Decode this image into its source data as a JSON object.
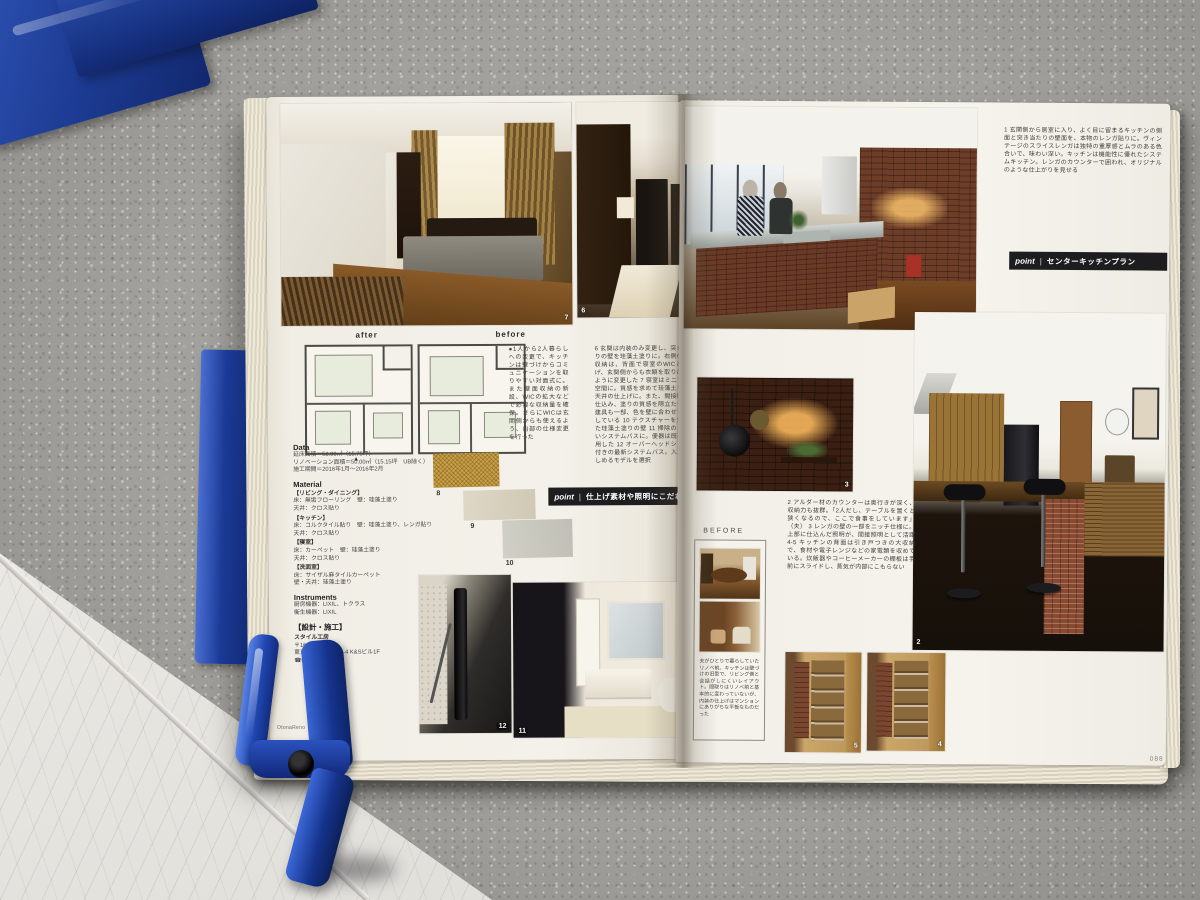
{
  "left_page": {
    "plans": {
      "after_label": "after",
      "before_label": "before",
      "entrance_marker": "▲"
    },
    "intro": "●1人から2人暮らしへの変更で、キッチンは壁づけからコミュニケーションを取りやすい対面式に。また壁面収納の新設、WICの拡大などで必要な収納量を確保。さらにWICは玄関側からも使えるよう、内部の仕様変更を行った",
    "captions": "6 玄関は内装のみ変更し、突き当たりの壁を珪藻土塗りに。右側の玄関収納は、背面で寝室のWICとつなげ、玄関側からも衣類を取り出せるように変更した 7 寝室はミニマムな空間に。質感を求めて珪藻土を壁や天井の仕上げに。また、間接照明を仕込み、塗りの質感を際立たせた。建具も一部、色を壁に合わせて変更している 10 テクスチャーを生かした珪藻土塗りの壁 11 掃除のしやすいシステムバスに。便器は既存を利用した 12 オーバーヘッドシャワー付きの最新システムバス。入浴が楽しめるモデルを選択",
    "data": {
      "heading": "Data",
      "lines": [
        "延床面積＝52.00㎡（15.75坪）",
        "リノベーション面積＝50.00㎡（15.15坪　UB除く）",
        "施工期間＝2016年1月〜2016年2月"
      ]
    },
    "material": {
      "heading": "Material",
      "lines": [
        "【リビング・ダイニング】",
        "床：無垢フローリング　壁：珪藻土塗り",
        "天井：クロス貼り",
        "【キッチン】",
        "床：コルクタイル貼り　壁：珪藻土塗り、レンガ貼り",
        "天井：クロス貼り",
        "【寝室】",
        "床：カーペット　壁：珪藻土塗り",
        "天井：クロス貼り",
        "【洗面室】",
        "床：サイザル麻タイルカーペット",
        "壁・天井：珪藻土塗り"
      ]
    },
    "instruments": {
      "heading": "Instruments",
      "lines": [
        "厨房機器：LIXIL、トクラス",
        "衛生機器：LIXIL"
      ]
    },
    "builder": {
      "heading": "【設計・施工】",
      "lines": [
        "スタイル工房",
        "〒166-00…",
        "東京都杉並区…3-2-4 K&Sビル1F",
        "☎0120-5…"
      ]
    },
    "point": {
      "label": "point",
      "title": "仕上げ素材や照明にこだわる"
    },
    "numbers": {
      "n6": "6",
      "n7": "7",
      "n8": "8",
      "n9": "9",
      "n10": "10",
      "n11": "11",
      "n12": "12"
    },
    "logo": "OtonaReno"
  },
  "right_page": {
    "para1": "1 玄関側から居室に入り、よく目に留まるキッチンの側面と突き当たりの壁面を、本物のレンガ貼りに。ヴィンテージのスライスレンガは独特の重厚感とムラのある色合いで、味わい深い。キッチンは機能性に優れたシステムキッチン。レンガのカウンターで囲われ、オリジナルのような仕上がりを見せる",
    "point": {
      "label": "point",
      "title": "センターキッチンプラン"
    },
    "para2": "2 アルダー材のカウンターは奥行きが深く、収納力も抜群。「2人だし、テーブルを置くと狭くなるので、ここで食事をしています」（夫） 3 レンガの壁の一部をニッチ仕様に。上部に仕込んだ照明が、間接照明として活躍 4-5 キッチンの背面は引き戸つきの大収納で、食材や電子レンジなどの家電類を収めている。炊飯器やコーヒーメーカーの棚板は手前にスライドし、蒸気が内部にこもらない",
    "before": {
      "label": "BEFORE",
      "caption": "夫がひとりで暮らしていたリノベ前。キッチンは壁づけの旧型で、リビング側と会話がしにくいレイアウト。間取りはリノベ前と基本的に変わっていないが、内装の仕上げはマンションにありがちな平板なものだった"
    },
    "numbers": {
      "n1": "1",
      "n2": "2",
      "n3": "3",
      "n4": "4",
      "n5": "5"
    },
    "page_number": "088"
  }
}
